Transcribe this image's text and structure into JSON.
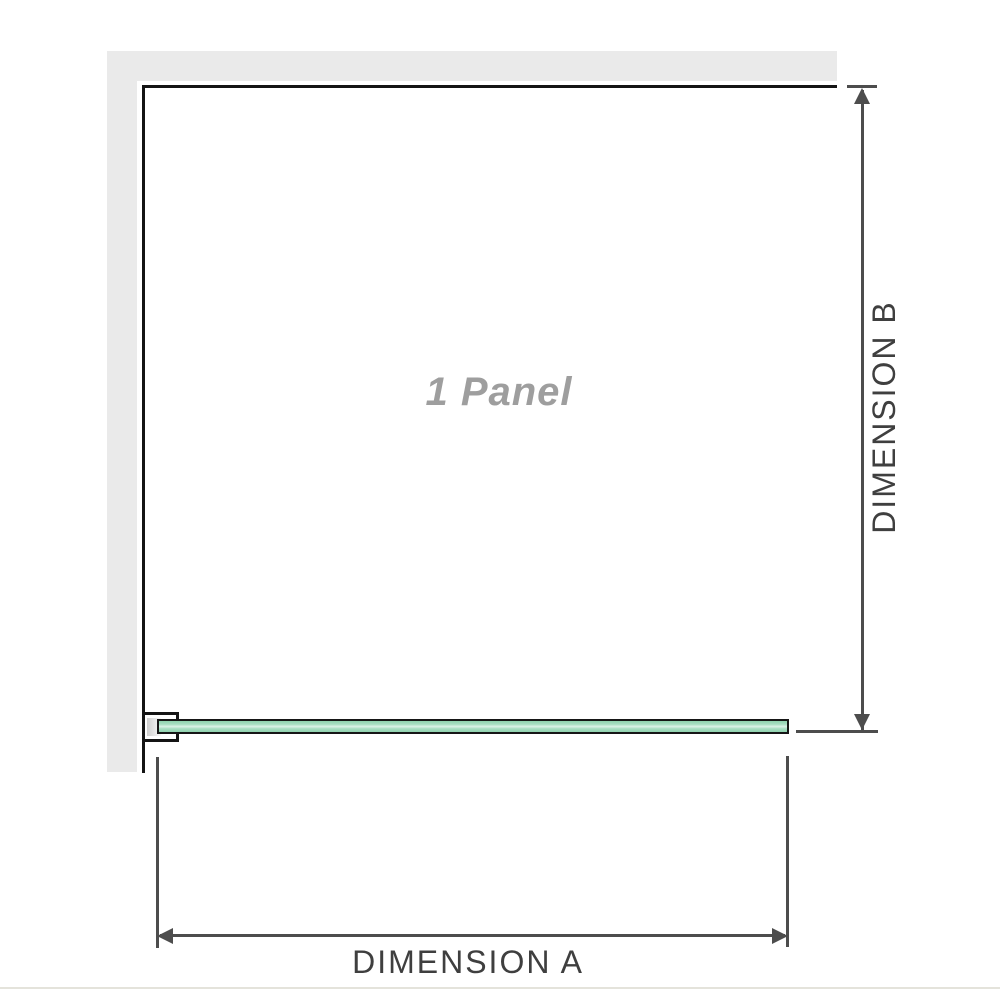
{
  "labels": {
    "panel": "1 Panel",
    "dimension_a": "DIMENSION A",
    "dimension_b": "DIMENSION B"
  },
  "colors": {
    "background": "#ffffff",
    "wall_fill": "#eaeaea",
    "wall_edge": "#141414",
    "glass_outline": "#161616",
    "glass_green": "#a9dec3",
    "glass_green_dark": "#8fd2ae",
    "glass_highlight": "#ddf2e8",
    "bracket_pad": "#cfcfcf",
    "dimension_line": "#4d4d4d",
    "dimension_text": "#3f3f3f",
    "panel_text": "#9e9e9e",
    "footer_rule": "#e4e3db"
  }
}
